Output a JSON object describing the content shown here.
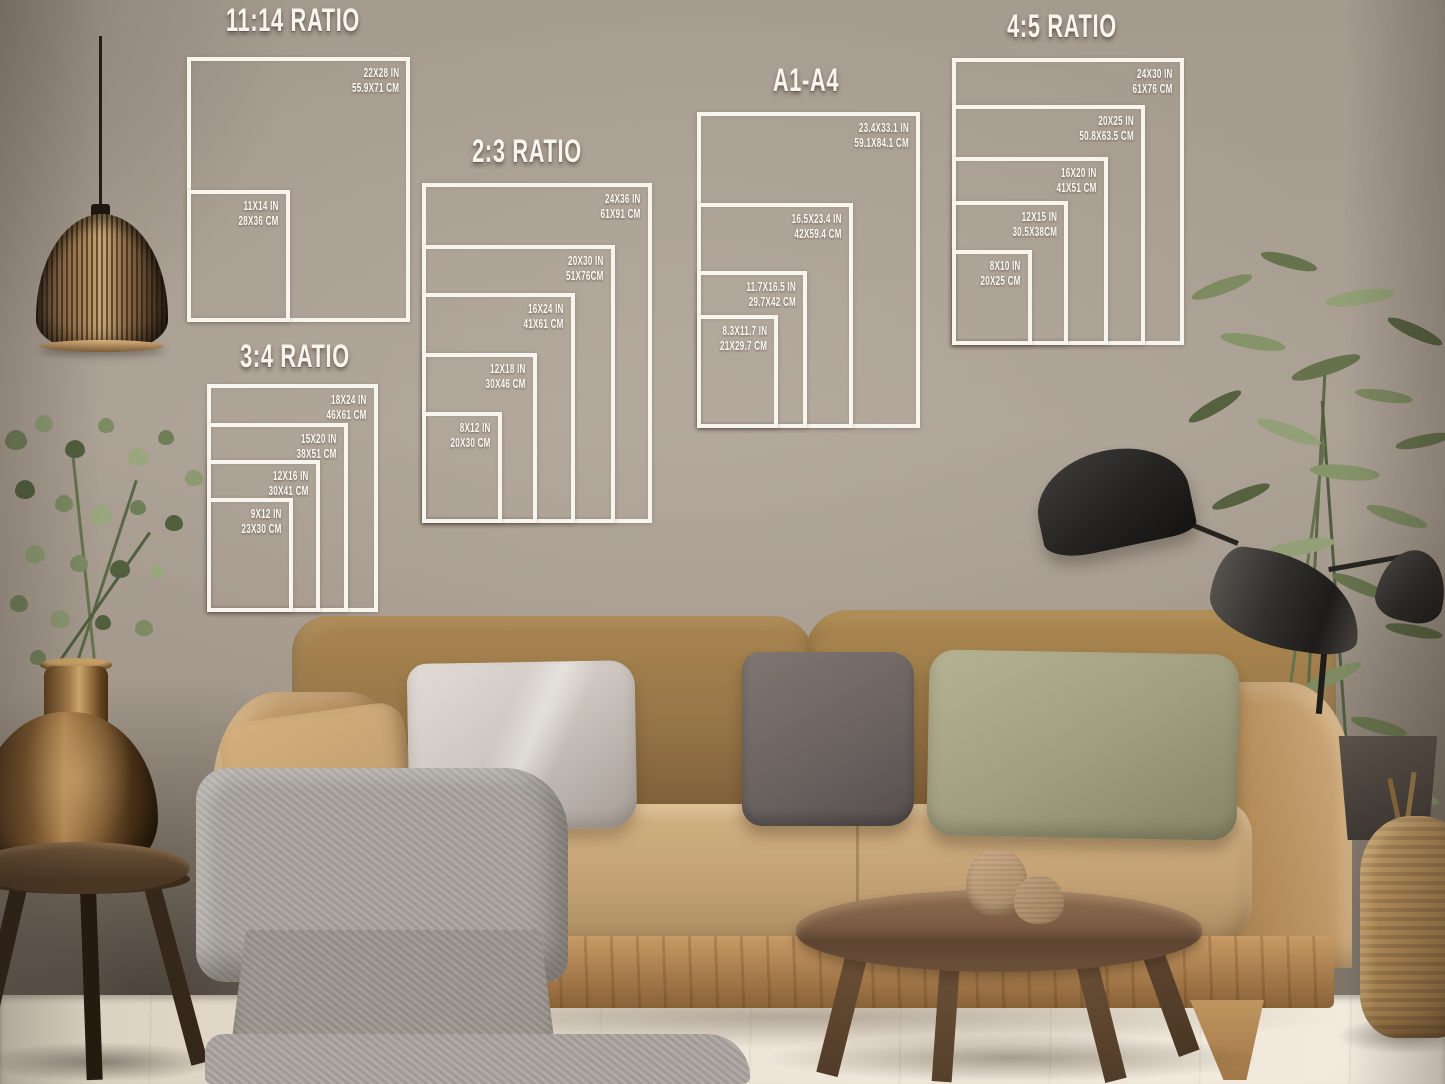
{
  "image_type": "wall-art print size guide mockup in living room",
  "size_charts": [
    {
      "id": "ratio-11-14",
      "title": "11:14 RATIO",
      "sizes": [
        {
          "in": "22X28 IN",
          "cm": "55.9X71 CM"
        },
        {
          "in": "11X14 IN",
          "cm": "28X36 CM"
        }
      ]
    },
    {
      "id": "ratio-2-3",
      "title": "2:3 RATIO",
      "sizes": [
        {
          "in": "24X36 IN",
          "cm": "61X91 CM"
        },
        {
          "in": "20X30 IN",
          "cm": "51X76CM"
        },
        {
          "in": "16X24 IN",
          "cm": "41X61 CM"
        },
        {
          "in": "12X18 IN",
          "cm": "30X46 CM"
        },
        {
          "in": "8X12 IN",
          "cm": "20X30 CM"
        }
      ]
    },
    {
      "id": "ratio-3-4",
      "title": "3:4 RATIO",
      "sizes": [
        {
          "in": "18X24 IN",
          "cm": "46X61 CM"
        },
        {
          "in": "15X20 IN",
          "cm": "38X51 CM"
        },
        {
          "in": "12X16 IN",
          "cm": "30X41 CM"
        },
        {
          "in": "9X12 IN",
          "cm": "23X30 CM"
        }
      ]
    },
    {
      "id": "a-series",
      "title": "A1-A4",
      "sizes": [
        {
          "in": "23.4X33.1 IN",
          "cm": "59.1X84.1 CM"
        },
        {
          "in": "16.5X23.4 IN",
          "cm": "42X59.4 CM"
        },
        {
          "in": "11.7X16.5 IN",
          "cm": "29.7X42 CM"
        },
        {
          "in": "8.3X11.7 IN",
          "cm": "21X29.7 CM"
        }
      ]
    },
    {
      "id": "ratio-4-5",
      "title": "4:5 RATIO",
      "sizes": [
        {
          "in": "24X30 IN",
          "cm": "61X76 CM"
        },
        {
          "in": "20X25 IN",
          "cm": "50.8X63.5 CM"
        },
        {
          "in": "16X20 IN",
          "cm": "41X51 CM"
        },
        {
          "in": "12X15 IN",
          "cm": "30.5X38CM"
        },
        {
          "in": "8X10 IN",
          "cm": "20X25 CM"
        }
      ]
    }
  ],
  "scene": {
    "objects": [
      "rattan-pendant-lamp",
      "eucalyptus-branches",
      "bronze-bottle-vase",
      "dark-wood-stool",
      "tan-velvet-sofa",
      "silver-pillow",
      "charcoal-pillow",
      "sage-pillow",
      "tan-pillow",
      "gray-throw-blanket",
      "round-wood-coffee-table",
      "ceramic-vases",
      "black-sculptural-floor-lamp",
      "tall-green-plant",
      "dark-planter",
      "jute-floor-vase"
    ]
  },
  "colors": {
    "outline_white": "#f8f5ef",
    "wall": "#a99f93",
    "floor": "#ece4d5",
    "sofa_tan": "#c2a074",
    "sofa_dark": "#8a6a43",
    "wood_dark": "#6b4f37",
    "pillow_silver": "#cfc9c3",
    "pillow_charcoal": "#6b6360",
    "pillow_sage": "#a3a083",
    "blanket_gray": "#a7a29c",
    "lamp_black": "#26231f",
    "bronze": "#9a6f3d",
    "greenery": "#76815c",
    "jute": "#bb9662"
  }
}
